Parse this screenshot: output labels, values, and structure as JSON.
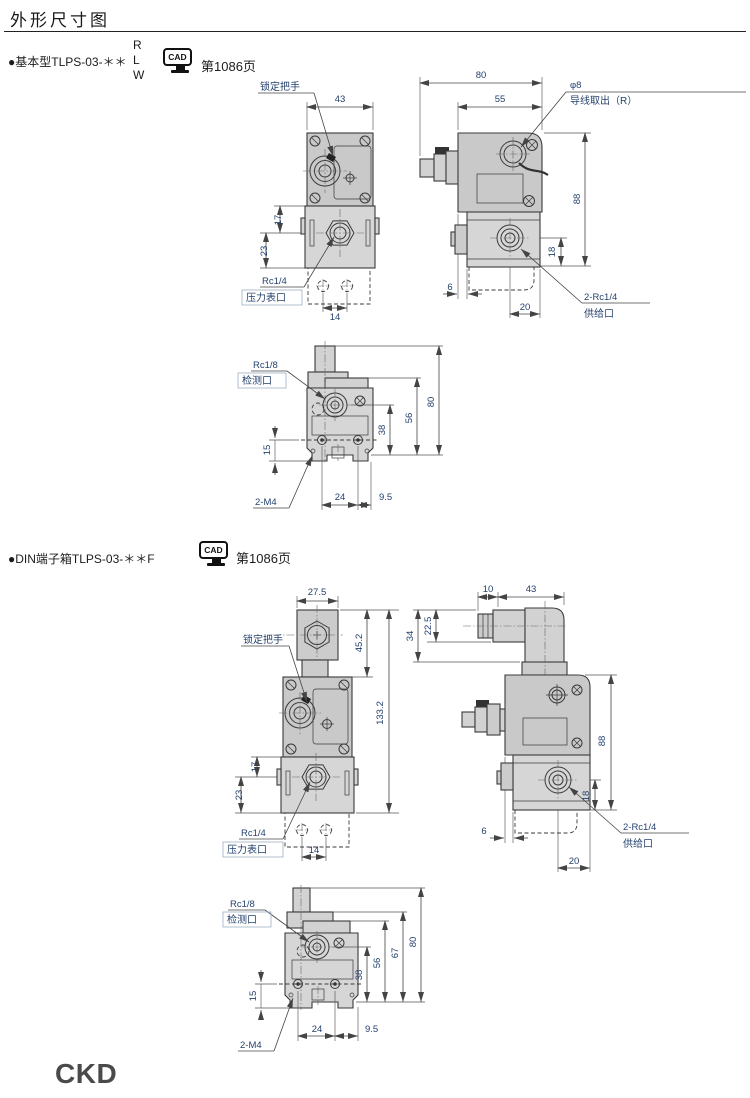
{
  "page": {
    "title": "外形尺寸图",
    "logo": "CKD"
  },
  "sections": {
    "basic": {
      "label": "●基本型TLPS-03-＊＊",
      "variants": [
        "R",
        "L",
        "W"
      ],
      "cad_label": "CAD",
      "page_ref": "第1086页"
    },
    "din": {
      "label": "●DIN端子箱TLPS-03-＊＊F",
      "cad_label": "CAD",
      "page_ref": "第1086页"
    }
  },
  "drawings": {
    "basic_front": {
      "lock_handle": "锁定把手",
      "dim_width_43": "43",
      "dim_17": "17",
      "dim_23": "23",
      "gauge_thread": "Rc1/4",
      "gauge_port": "压力表口",
      "dim_14": "14"
    },
    "basic_side": {
      "dim_80": "80",
      "dim_55": "55",
      "wire_dia": "φ8",
      "wire_label": "导线取出（R）",
      "dim_88": "88",
      "dim_18": "18",
      "dim_6": "6",
      "dim_20": "20",
      "supply_thread": "2-Rc1/4",
      "supply_port": "供给口"
    },
    "basic_bottom": {
      "check_thread": "Rc1/8",
      "check_port": "检测口",
      "dim_80": "80",
      "dim_56": "56",
      "dim_38": "38",
      "dim_15": "15",
      "mount_thread": "2-M4",
      "dim_24": "24",
      "dim_9_5": "9.5"
    },
    "din_front": {
      "dim_27_5": "27.5",
      "lock_handle": "锁定把手",
      "dim_45_2": "45.2",
      "dim_133_2": "133.2",
      "dim_17": "17",
      "dim_23": "23",
      "gauge_thread": "Rc1/4",
      "gauge_port": "压力表口",
      "dim_14": "14"
    },
    "din_side": {
      "dim_10": "10",
      "dim_43": "43",
      "dim_34": "34",
      "dim_22_5": "22.5",
      "dim_88": "88",
      "dim_18": "18",
      "dim_6": "6",
      "dim_20": "20",
      "supply_thread": "2-Rc1/4",
      "supply_port": "供给口"
    },
    "din_bottom": {
      "check_thread": "Rc1/8",
      "check_port": "检测口",
      "dim_80": "80",
      "dim_67": "67",
      "dim_56": "56",
      "dim_38": "38",
      "dim_15": "15",
      "mount_thread": "2-M4",
      "dim_24": "24",
      "dim_9_5": "9.5"
    }
  }
}
